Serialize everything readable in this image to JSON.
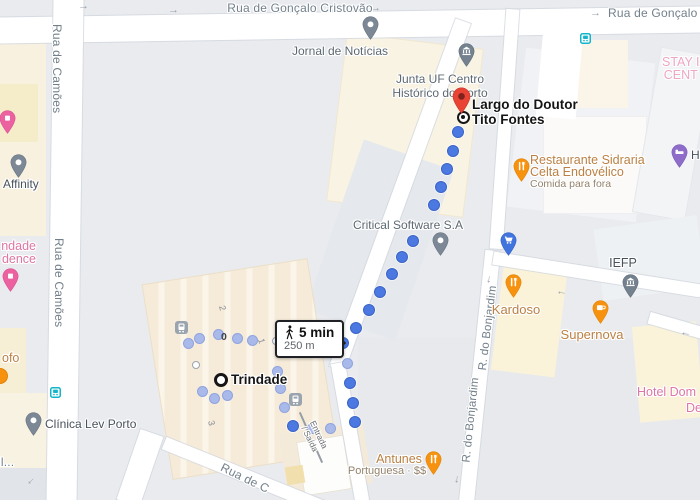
{
  "streets": {
    "goncalo_cristovao": "Rua de Gonçalo Cristovão",
    "goncalo_cristovao_right": "Rua de Gonçalo C",
    "camoes_top": "Rua de Camões",
    "camoes_bottom": "Rua de Camões",
    "bonjardim_1": "R. do Bonjardim",
    "bonjardim_2": "R. do Bonjardim",
    "rua_de_c": "Rua de C",
    "entrada_line1": "Entrada",
    "entrada_line2": "/ Saída"
  },
  "pois": {
    "jornal": "Jornal de Notícias",
    "junta_line1": "Junta UF Centro",
    "junta_line2": "Histórico do Porto",
    "stay_line1": "STAY I",
    "stay_line2": "CENT",
    "affinity": "Affinity",
    "residence_line1": "ndade",
    "residence_line2": "dence",
    "ofo": "ofo",
    "clinica": "Clínica Lev Porto",
    "il": "il...",
    "critical": "Critical Software S.A",
    "sidraria_line1": "Restaurante Sidraria",
    "sidraria_line2": "Celta Endovélico",
    "sidraria_line3": "Comida para fora",
    "hotel_h": "H",
    "iefp": "IEFP",
    "kardoso": "Kardoso",
    "supernova": "Supernova",
    "hotel_dom_line1": "Hotel Dom",
    "hotel_dom_line2": "De",
    "antunes_line1": "Antunes",
    "antunes_line2": "Portuguesa · $$"
  },
  "route": {
    "mode": "walking",
    "duration": "5 min",
    "distance": "250 m",
    "origin_label": "Trindade",
    "destination_line1": "Largo do Doutor",
    "destination_line2": "Tito Fontes",
    "dots": [
      [
        458,
        132
      ],
      [
        453,
        151
      ],
      [
        447,
        169
      ],
      [
        441,
        187
      ],
      [
        434,
        205
      ],
      [
        413,
        241
      ],
      [
        402,
        257
      ],
      [
        392,
        274
      ],
      [
        380,
        292
      ],
      [
        369,
        310
      ],
      [
        356,
        328
      ],
      [
        343,
        343
      ],
      [
        350,
        383
      ],
      [
        353,
        403
      ],
      [
        355,
        422
      ],
      [
        293,
        426
      ]
    ],
    "station_dots": [
      [
        188,
        343
      ],
      [
        199,
        338
      ],
      [
        218,
        334
      ],
      [
        237,
        338
      ],
      [
        252,
        340
      ],
      [
        277,
        371
      ],
      [
        280,
        388
      ],
      [
        284,
        407
      ],
      [
        202,
        391
      ],
      [
        214,
        398
      ],
      [
        227,
        395
      ],
      [
        312,
        428
      ],
      [
        330,
        428
      ],
      [
        347,
        363
      ]
    ],
    "exit_rings": [
      [
        276,
        341
      ],
      [
        196,
        365
      ]
    ]
  },
  "station": {
    "platform_2": "2",
    "platform_0": "0",
    "platform_1": "1",
    "platform_3": "3"
  },
  "icons": {
    "one_way_arrow": "→"
  },
  "colors": {
    "map_bg": "#e9ebee",
    "street": "#ffffff",
    "route_blue": "#4b79e1",
    "station_dot_blue": "#a9b9ea",
    "red_pin": "#e94335",
    "slate_pin": "#7c8896",
    "food_pin": "#f6920e",
    "cart_pin": "#4274dd",
    "lodging_purple": "#8e6cc9",
    "lodging_pink": "#ec619f",
    "transit_teal": "#12b5c9",
    "hotel_text_pink": "#dd76a4",
    "food_text": "#bb8044"
  }
}
